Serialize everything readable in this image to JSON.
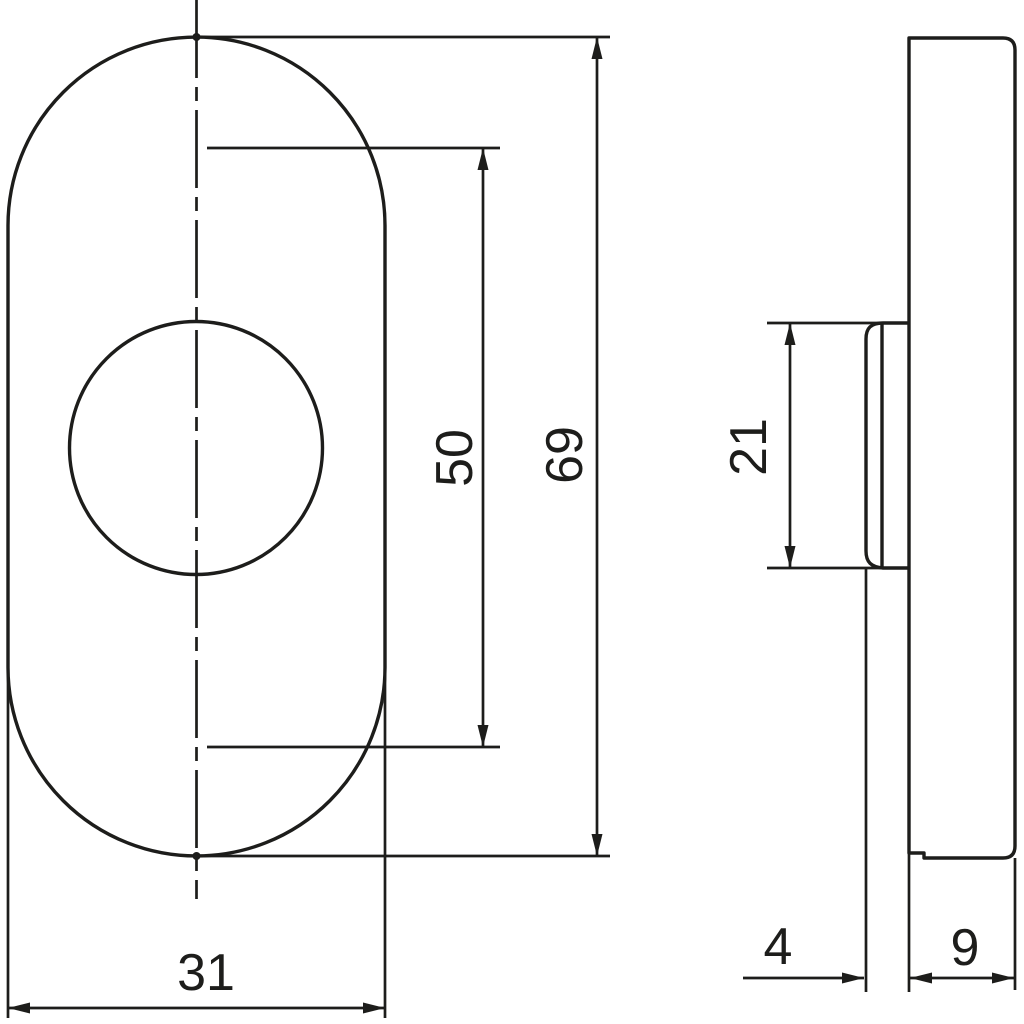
{
  "drawing": {
    "labels": {
      "overall_height": "69",
      "inner_length": "50",
      "overall_width": "31",
      "hub_diameter": "21",
      "base_thickness": "4",
      "cover_thickness": "9"
    },
    "colors": {
      "line": "#1d1d1b",
      "background": "#ffffff"
    }
  }
}
